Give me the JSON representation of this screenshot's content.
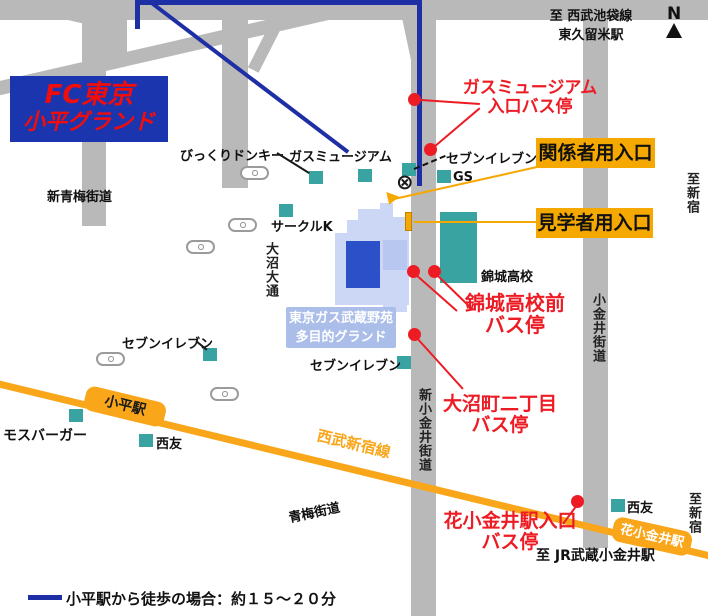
{
  "colors": {
    "road_gray": "#b9b9b9",
    "route_navy": "#1e2fa6",
    "railway_orange": "#f9a61a",
    "entrance_orange": "#f5a800",
    "bus_stop_red": "#ed1c24",
    "shop_teal": "#39a3a2",
    "facility_light": "#ccd7f5",
    "ground_blue": "#2c50c8",
    "fc_box_blue": "#1a35ae"
  },
  "title": {
    "line1": "FC東京",
    "line2": "小平グランド"
  },
  "compass": {
    "label": "N"
  },
  "icons": {
    "railroad_crossing": "⊗"
  },
  "directions": {
    "seibu_ikebukuro": "至 西武池袋線",
    "higashi_kurume": "東久留米駅",
    "shinjuku_top": "至新宿",
    "shinjuku_bottom": "至新宿",
    "jr_musashi_koganei": "至 JR武蔵小金井駅"
  },
  "roads": {
    "shin_oume_kaido": "新青梅街道",
    "oume_kaido": "青梅街道",
    "shin_koganei_kaido": "新小金井街道",
    "koganei_kaido": "小金井街道",
    "onuma_odori": "大沼大通"
  },
  "railway": {
    "line_name": "西武新宿線",
    "kodaira_station": "小平駅",
    "hana_koganei_station": "花小金井駅"
  },
  "entrances": {
    "staff": "関係者用入口",
    "visitor": "見学者用入口"
  },
  "bus_stops": {
    "gas_museum": {
      "line1": "ガスミュージアム",
      "line2": "入口バス停"
    },
    "kinjo_mae": {
      "line1": "錦城高校前",
      "line2": "バス停"
    },
    "onuma_2chome": {
      "line1": "大沼町二丁目",
      "line2": "バス停"
    },
    "hana_koganei_iriguchi": {
      "line1": "花小金井駅入口",
      "line2": "バス停"
    }
  },
  "facility": {
    "label_line1": "東京ガス武蔵野苑",
    "label_line2": "多目的グランド"
  },
  "pois": {
    "bikkuri_donkey": "びっくりドンキー",
    "gas_museum": "ガスミュージアム",
    "seven_eleven_north": "セブンイレブン",
    "gas_station": "GS",
    "circle_k": "サークルK",
    "kinjo_high_school": "錦城高校",
    "seven_eleven_west": "セブンイレブン",
    "seven_eleven_south": "セブンイレブン",
    "mos_burger": "モスバーガー",
    "seiyu_west": "西友",
    "seiyu_east": "西友"
  },
  "legend": {
    "walk_note": "小平駅から徒歩の場合：約１５～２０分"
  }
}
